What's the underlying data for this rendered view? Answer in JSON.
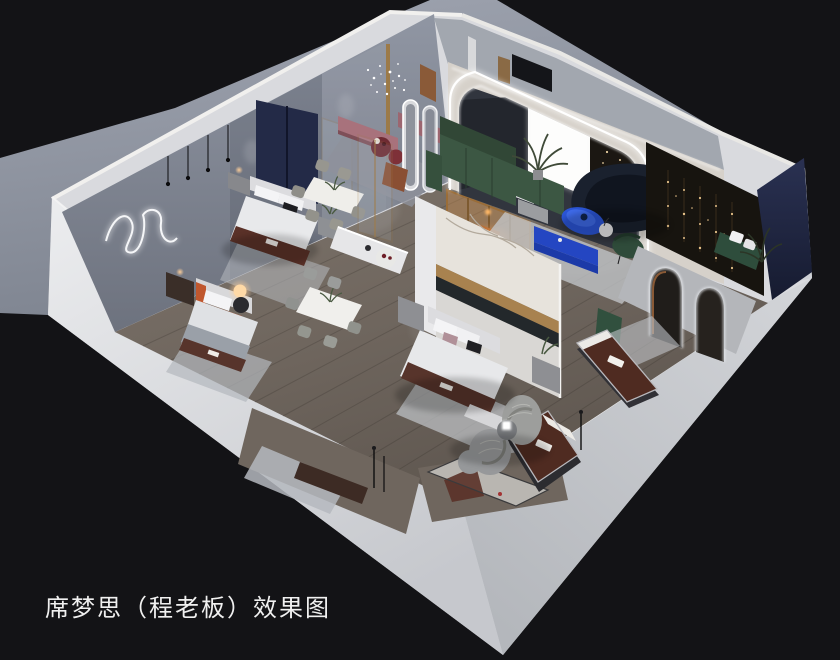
{
  "caption": {
    "text": "席梦思（程老板）效果图"
  },
  "colors": {
    "background": "#131316",
    "ground": "#959ba7",
    "ground_dark": "#7e8490",
    "wall_base": "#d9dade",
    "wall_band_light": "#e7e8ea",
    "wall_band_shade": "#c3c5ca",
    "wall_inner": "#868b98",
    "wall_inner_dark": "#6d727e",
    "inner_strip": "#a2a7af",
    "floor": "#6f665e",
    "floor_light": "#8a7f74",
    "arch_cream": "#d6d1ca",
    "led": "#ffffff",
    "niche_bg": "#31353e",
    "panel_white": "#fbfbf9",
    "panel_dark": "#1b1712",
    "sofa_green": "#3c5743",
    "sofa_green_dark": "#314736",
    "sofa_navy": "#1a212e",
    "accent_blue": "#2b55d6",
    "cabinet_blue": "#2446c2",
    "bench_pink": "#a8727c",
    "table_burgundy": "#6e2a32",
    "marble": "#e7e3dc",
    "gold": "#a8824f",
    "wood": "#8a6a45",
    "amber": "#c98a4a",
    "navy_wall": "#232a47",
    "feature_dark": "#17140f",
    "rug": "#bcbfc5",
    "bed_white": "#e8e9eb",
    "mattress_brown": "#4f2b21",
    "runner_brown": "#5a3128",
    "quilt_gray": "#b9b6b1",
    "knit_gray": "#9d9e9c",
    "caption_color": "#f0f0f0"
  },
  "scene": {
    "type": "3d-interior-rendering",
    "view": "isometric dollhouse cutaway, black backdrop, gray ground plane upper-left",
    "rooms": [
      {
        "name": "bedroom-display-left",
        "items": [
          "wavy-neon-wall-art",
          "pendant-lights",
          "bed-with-navy-headboard",
          "nightstands",
          "rug"
        ]
      },
      {
        "name": "bedroom-display-lower-left",
        "items": [
          "bed-with-orange-accent",
          "glowing-globe-lamp",
          "dark-nightstand",
          "rug"
        ]
      },
      {
        "name": "dining-displays",
        "items": [
          "marble-dining-table-1",
          "marble-dining-table-2",
          "gray-chairs",
          "white-display-benches",
          "pedestal-tables"
        ]
      },
      {
        "name": "lounge-pink",
        "items": [
          "mauve-benches",
          "burgundy-round-tables",
          "crystal-chandelier",
          "rug"
        ]
      },
      {
        "name": "living-room-led-arch",
        "items": [
          "led-arch-wall",
          "backlit-white-panel",
          "green-sectional-sofa",
          "navy-curved-sofa",
          "blue-oval-table",
          "blue-tv-cabinet",
          "palm-plant",
          "globe-floor-lamp",
          "green-accent-chair"
        ]
      },
      {
        "name": "center-bedroom",
        "items": [
          "marble-gold-feature-wall",
          "bed-with-brand-runner",
          "nightstands",
          "foot-bench",
          "rug"
        ]
      },
      {
        "name": "east-lounge",
        "items": [
          "dark-feature-wall-string-lights",
          "navy-corner-wall",
          "green-bench-white-pillows",
          "arched-mirror-doorways",
          "palm-plant"
        ]
      },
      {
        "name": "mattress-gallery",
        "items": [
          "brown-brand-mattress-1",
          "brown-brand-mattress-2",
          "light-quilted-mattress",
          "knitted-swivel-chairs",
          "knitted-poufs",
          "cube-lamp-side-table",
          "floor-reading-lamp",
          "display-niche-bench"
        ]
      }
    ]
  }
}
